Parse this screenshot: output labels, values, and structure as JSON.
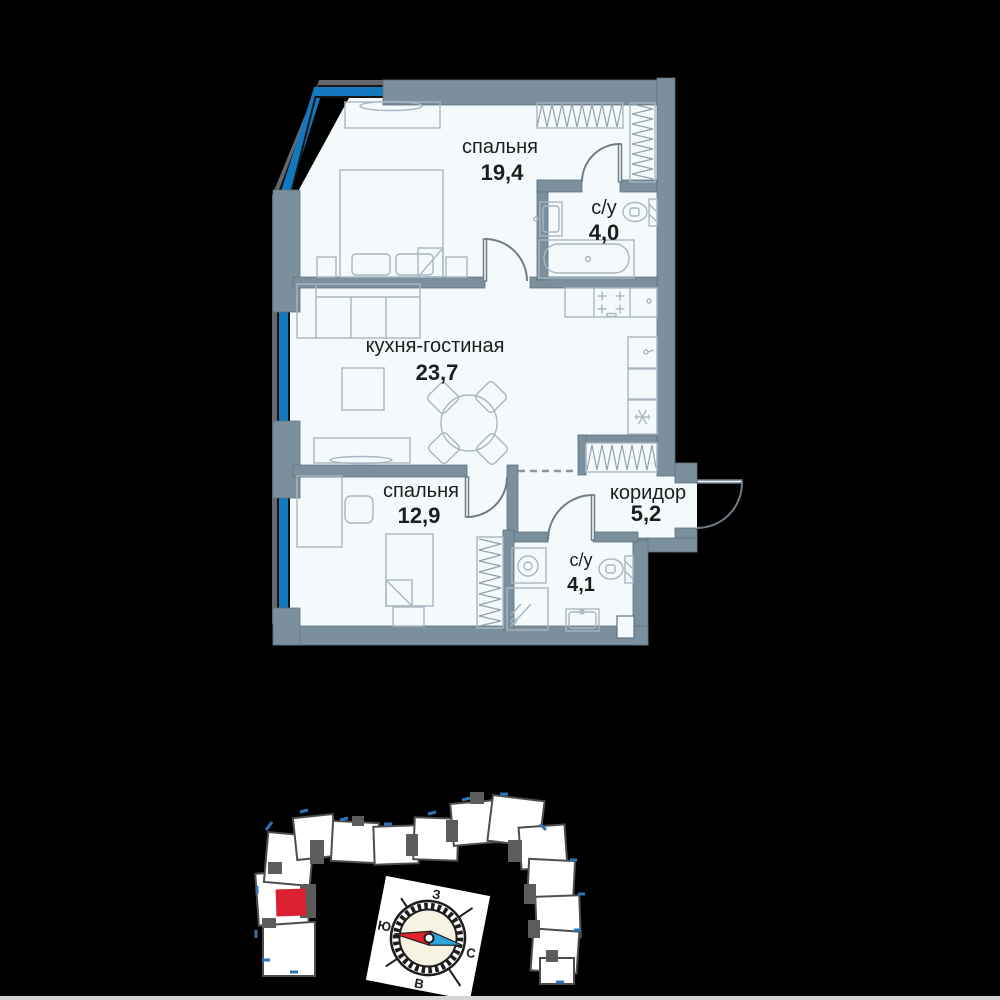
{
  "floor_plan": {
    "rooms": [
      {
        "id": "bedroom-1",
        "name": "спальня",
        "area": "19,4"
      },
      {
        "id": "bathroom-1",
        "name": "с/у",
        "area": "4,0"
      },
      {
        "id": "kitchen-living",
        "name": "кухня-гостиная",
        "area": "23,7"
      },
      {
        "id": "bedroom-2",
        "name": "спальня",
        "area": "12,9"
      },
      {
        "id": "corridor",
        "name": "коридор",
        "area": "5,2"
      },
      {
        "id": "bathroom-2",
        "name": "с/у",
        "area": "4,1"
      }
    ],
    "colors": {
      "wall": "#7b909c",
      "floor": "#f4f9fb",
      "window_blue": "#1478be",
      "text": "#1d1d1d"
    }
  },
  "site_plan": {
    "highlight_color": "#da2031"
  },
  "compass": {
    "labels": {
      "top": "З",
      "left": "Ю",
      "right": "С",
      "bottom": "В"
    },
    "needle": {
      "south_color": "#e02428",
      "north_color": "#2ea4dd"
    }
  }
}
